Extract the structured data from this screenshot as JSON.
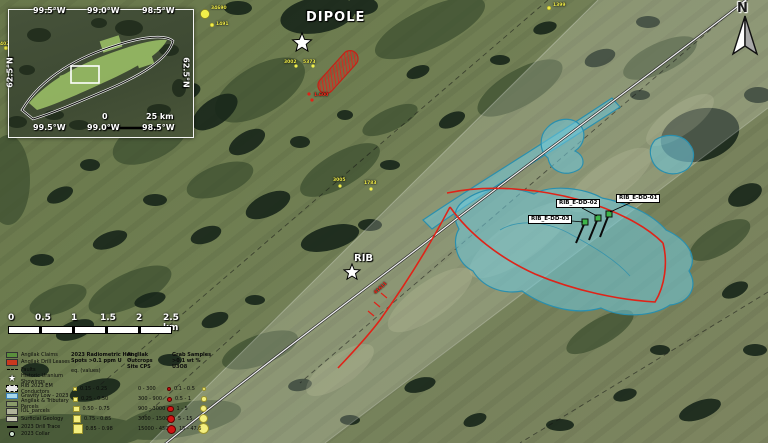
{
  "map": {
    "dipole_label": "DIPOLE",
    "rib_label": "RIB",
    "north_label": "N",
    "drill_holes": [
      {
        "label": "RIB_E-DD-01"
      },
      {
        "label": "RIB_E-DD-02"
      },
      {
        "label": "RIB_E-DD-03"
      }
    ],
    "samples": [
      {
        "label": "34690",
        "color": "yellow"
      },
      {
        "label": "1491",
        "color": "yellow"
      },
      {
        "label": "1399",
        "color": "yellow"
      },
      {
        "label": "3002",
        "color": "yellow"
      },
      {
        "label": "5373",
        "color": "yellow"
      },
      {
        "label": "1.600",
        "color": "red"
      },
      {
        "label": "3005",
        "color": "yellow"
      },
      {
        "label": "1783",
        "color": "yellow"
      },
      {
        "label": "41611",
        "color": "red"
      },
      {
        "label": "402",
        "color": "yellow"
      }
    ]
  },
  "inset": {
    "top_labels": [
      "99.5°W",
      "99.0°W",
      "98.5°W"
    ],
    "bottom_labels": [
      "99.5°W",
      "99.0°W",
      "98.5°W"
    ],
    "left_label": "62.5°N",
    "right_label": "62.5°N",
    "scale_zero": "0",
    "scale_label": "25 km"
  },
  "scalebar": {
    "ticks": [
      "0",
      "0.5",
      "1",
      "1.5",
      "2",
      "2.5 km"
    ]
  },
  "legend": {
    "items": [
      {
        "label": "Angilak Claims"
      },
      {
        "label": "Angilak Drill Leases"
      },
      {
        "label": "Faults"
      },
      {
        "label": "Historic Uranium Showings"
      },
      {
        "label": "RIB 2023 EM Conductors"
      },
      {
        "label": "Gravity Low - 2023"
      },
      {
        "label": "Angilak & Tributary Parcels"
      },
      {
        "label": "IOL_parcels"
      },
      {
        "label": "Surficial Geology"
      },
      {
        "label": "2023 Drill Trace"
      },
      {
        "label": "2023 Collar"
      }
    ],
    "radiometric": {
      "header_lines": [
        "2023 Radiometric Hot",
        "Spots >0.1 ppm U",
        "eq. (values)"
      ],
      "classes": [
        "0.15 - 0.25",
        "0.25 - 0.50",
        "0.50 - 0.75",
        "0.75 - 0.85",
        "0.85 - 0.98"
      ]
    },
    "outcrops": {
      "header_lines": [
        "Angilak Outcrops",
        "Site CPS"
      ],
      "classes": [
        "0 - 300",
        "300 - 900",
        "900 - 3000",
        "3000 - 15000",
        "15000 - 45005"
      ]
    },
    "grab": {
      "header_lines": [
        "Grab Samples",
        ">0.1 wt % U3O8"
      ],
      "classes": [
        "0.1 - 0.5",
        "0.5 - 1",
        "1 - 5",
        "5 - 15",
        "15 - 47.6"
      ]
    }
  },
  "colors": {
    "gravity_low_fill": "#6ec9dc",
    "gravity_low_stroke": "#2a8fae",
    "hot_spot_red": "#d42a1e",
    "claim_green": "#9fc468",
    "collar_green": "#3db54a",
    "road_white": "#f2f2f2"
  }
}
